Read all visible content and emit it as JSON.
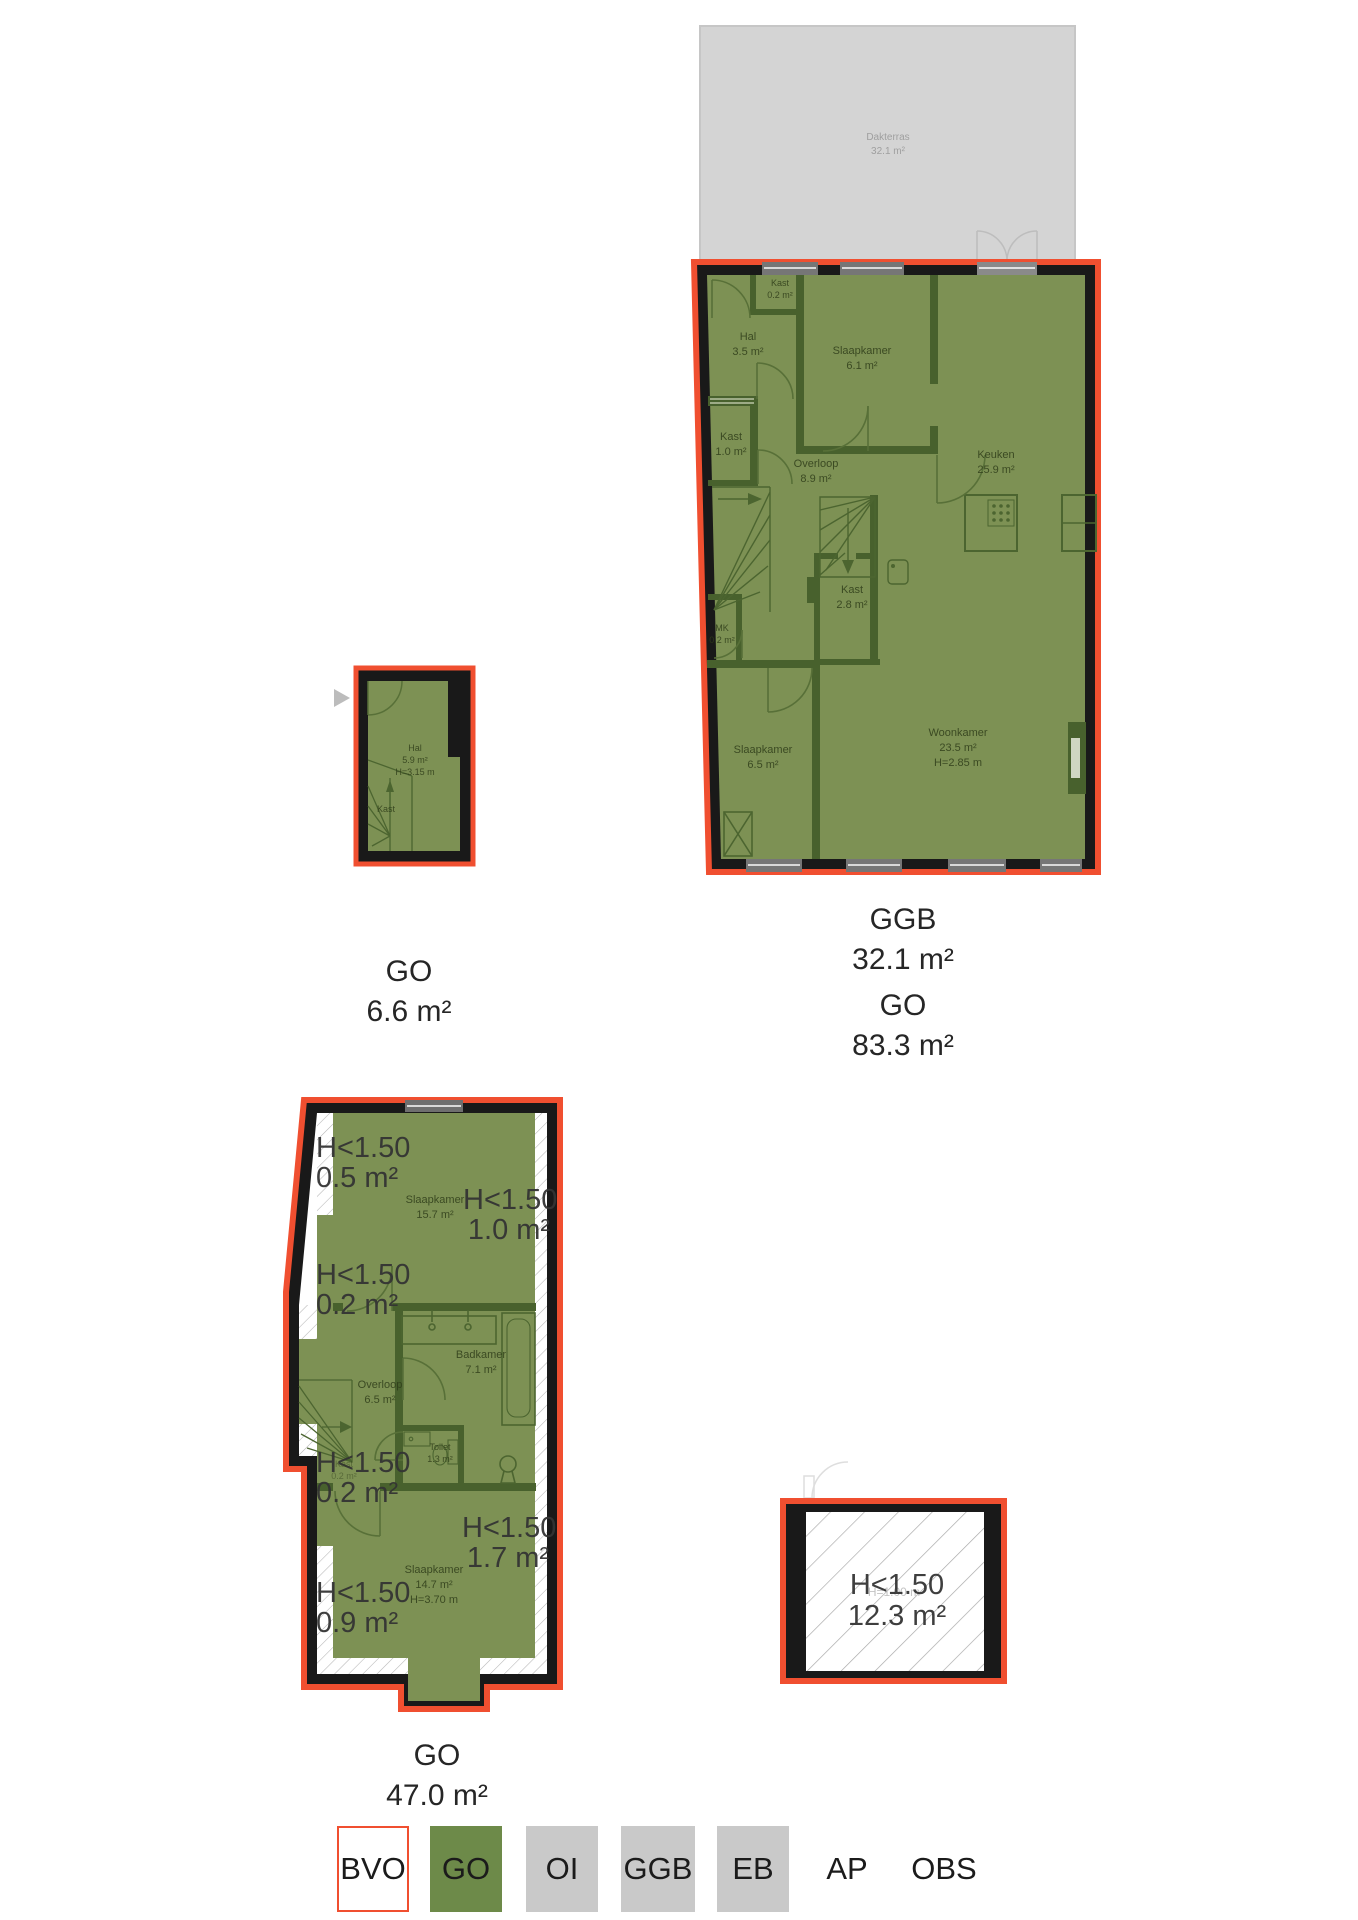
{
  "colors": {
    "bvo_red": "#f04f30",
    "go_green": "#6d8a49",
    "plan_green": "#7d9154",
    "room_wall_green": "#48612d",
    "structural_wall": "#191919",
    "terrace_gray": "#d4d4d4",
    "legend_gray": "#c9c9c9",
    "hatch_gray": "#b5b5b5",
    "annotation_text": "#343434",
    "room_text": "#2f3d1a"
  },
  "upper_plan": {
    "terrace": {
      "name": "Dakterras",
      "area": "32.1 m²"
    },
    "rooms": {
      "kast_top": {
        "name": "Kast",
        "area": "0.2 m²"
      },
      "hal": {
        "name": "Hal",
        "area": "3.5 m²"
      },
      "slaapkamer1": {
        "name": "Slaapkamer",
        "area": "6.1 m²"
      },
      "kast1": {
        "name": "Kast",
        "area": "1.0 m²"
      },
      "overloop": {
        "name": "Overloop",
        "area": "8.9 m²"
      },
      "keuken": {
        "name": "Keuken",
        "area": "25.9 m²"
      },
      "kast2": {
        "name": "Kast",
        "area": "2.8 m²"
      },
      "mk": {
        "name": "MK",
        "area": "0.2 m²"
      },
      "slaapkamer2": {
        "name": "Slaapkamer",
        "area": "6.5 m²"
      },
      "woonkamer": {
        "name": "Woonkamer",
        "area": "23.5 m²",
        "height": "H=2.85 m"
      }
    },
    "summary": {
      "line1": "GGB",
      "line2": "32.1 m²",
      "line3": "GO",
      "line4": "83.3 m²"
    }
  },
  "entry_plan": {
    "rooms": {
      "hal": {
        "name": "Hal",
        "area": "5.9 m²",
        "height": "H=3.15 m"
      },
      "kast": {
        "name": "Kast"
      }
    },
    "summary": {
      "line1": "GO",
      "line2": "6.6 m²"
    }
  },
  "lower_plan": {
    "annotations": {
      "a1": {
        "label": "H<1.50",
        "area": "0.5 m²"
      },
      "a2": {
        "label": "H<1.50",
        "area": "1.0 m²"
      },
      "a3": {
        "label": "H<1.50",
        "area": "0.2 m²"
      },
      "a4": {
        "label": "H<1.50",
        "area": "0.2 m²"
      },
      "a5": {
        "label": "H<1.50",
        "area": "1.7 m²"
      },
      "a6": {
        "label": "H<1.50",
        "area": "0.9 m²"
      }
    },
    "rooms": {
      "slaapkamer1": {
        "name": "Slaapkamer",
        "area": "15.7 m²"
      },
      "badkamer": {
        "name": "Badkamer",
        "area": "7.1 m²"
      },
      "overloop": {
        "name": "Overloop",
        "area": "6.5 m²"
      },
      "toilet": {
        "name": "Toilet",
        "area": "1.3 m²"
      },
      "kast": {
        "name": "Kast",
        "area": "0.2 m²"
      },
      "slaapkamer2": {
        "name": "Slaapkamer",
        "area": "14.7 m²",
        "height": "H=3.70 m"
      }
    },
    "summary": {
      "line1": "GO",
      "line2": "47.0 m²"
    }
  },
  "attic_plan": {
    "annotation": {
      "label": "H<1.50",
      "area": "12.3 m²"
    },
    "faint_height": "H=1.00 m"
  },
  "legend": {
    "items": [
      {
        "label": "BVO",
        "fill": "#ffffff",
        "border": "#f04f30"
      },
      {
        "label": "GO",
        "fill": "#6d8a49",
        "border": ""
      },
      {
        "label": "OI",
        "fill": "#c9c9c9",
        "border": ""
      },
      {
        "label": "GGB",
        "fill": "#c9c9c9",
        "border": ""
      },
      {
        "label": "EB",
        "fill": "#c9c9c9",
        "border": ""
      },
      {
        "label": "AP",
        "fill": "",
        "border": ""
      },
      {
        "label": "OBS",
        "fill": "",
        "border": ""
      }
    ]
  }
}
